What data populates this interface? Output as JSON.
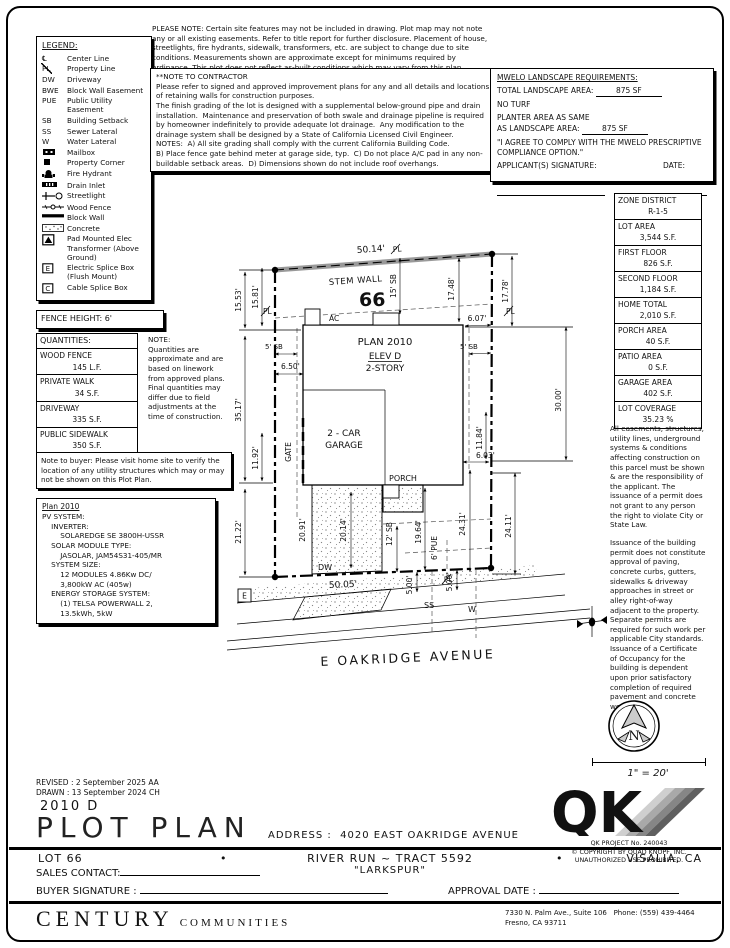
{
  "header": {
    "please_note": "PLEASE NOTE:  Certain site features may not be included in drawing.  Plot map may not note any or all existing easements.  Refer to title report for further disclosure.  Placement of house, streetlights, fire hydrants, sidewalk, transformers, etc. are subject to change due to site conditions.  Measurements shown are approximate except for minimums required by ordinance.  This plot does not reflect as-built conditions which may vary from this plan.",
    "contractor_title": "**NOTE TO CONTRACTOR",
    "contractor_body": "Please refer to signed and approved improvement plans for any and all details and locations of retaining walls for construction purposes.\nThe finish grading of the lot is designed with a supplemental below-ground pipe and drain installation.  Maintenance and preservation of both swale and drainage pipeline is required by homeowner indefinitely to provide adequate lot drainage.  Any modification to the drainage system shall be designed by a State of California Licensed Civil Engineer.\nNOTES:  A) All site grading shall comply with the current California Building Code.\nB) Place fence gate behind meter at garage side, typ.  C) Do not place A/C pad in any non-buildable setback areas.  D) Dimensions shown do not include roof overhangs."
  },
  "mwelo": {
    "title": "MWELO LANDSCAPE REQUIREMENTS:",
    "total_label": "TOTAL LANDSCAPE AREA:",
    "total_value": "875 SF",
    "no_turf": "NO TURF",
    "planter_line1": "PLANTER AREA AS SAME",
    "planter_line2": "AS LANDSCAPE AREA:",
    "planter_value": "875 SF",
    "agreement": "\"I AGREE TO COMPLY WITH THE MWELO PRESCRIPTIVE COMPLIANCE OPTION.\"",
    "signature_label": "APPLICANT(S) SIGNATURE:",
    "date_label": "DATE:"
  },
  "legend": {
    "title": "LEGEND:",
    "ebox_letter": "E",
    "cbox_letter": "C",
    "items": [
      {
        "sym": "℄",
        "label": "Center Line"
      },
      {
        "sym": "PL",
        "label": "Property Line"
      },
      {
        "sym": "DW",
        "label": "Driveway"
      },
      {
        "sym": "BWE",
        "label": "Block Wall Easement"
      },
      {
        "sym": "PUE",
        "label": "Public Utility Easement"
      },
      {
        "sym": "SB",
        "label": "Building Setback"
      },
      {
        "sym": "SS",
        "label": "Sewer Lateral"
      },
      {
        "sym": "W",
        "label": "Water Lateral"
      },
      {
        "label": "Mailbox"
      },
      {
        "label": "Property Corner"
      },
      {
        "label": "Fire Hydrant"
      },
      {
        "label": "Drain Inlet"
      },
      {
        "label": "Streetlight"
      },
      {
        "label": "Wood Fence"
      },
      {
        "label": "Block Wall"
      },
      {
        "label": "Concrete"
      },
      {
        "label": "Pad Mounted Elec Transformer (Above Ground)"
      },
      {
        "label": "Electric Splice Box (Flush Mount)"
      },
      {
        "label": "Cable Splice Box"
      }
    ]
  },
  "fence_height": "FENCE HEIGHT: 6'",
  "quantities": {
    "title": "QUANTITIES:",
    "rows": [
      {
        "label": "WOOD FENCE",
        "value": "145 L.F."
      },
      {
        "label": "PRIVATE WALK",
        "value": "34 S.F."
      },
      {
        "label": "DRIVEWAY",
        "value": "335 S.F."
      },
      {
        "label": "PUBLIC SIDEWALK",
        "value": "350 S.F."
      }
    ],
    "note_title": "NOTE:",
    "note": "Quantities are approximate and are based on linework from approved plans.  Final quantities may differ due to field adjustments at the time of construction."
  },
  "buyer_note": "Note to buyer: Please visit home site to verify the location of any utility structures which may or may not be shown on this Plot Plan.",
  "pv": {
    "title": "Plan 2010",
    "body": "PV SYSTEM:\n    INVERTER:\n        SOLAREDGE SE 3800H-USSR\n    SOLAR MODULE TYPE:\n        JASOLAR, JAM54S31-405/MR\n    SYSTEM SIZE:\n        12 MODULES 4.86Kw DC/\n        3,800kW AC (405w)\n    ENERGY STORAGE SYSTEM:\n        (1) TELSA POWERWALL 2,\n        13.5kWh, 5kW"
  },
  "zone_table": {
    "rows": [
      {
        "label": "ZONE DISTRICT",
        "value": "R-1-5"
      },
      {
        "label": "LOT AREA",
        "value": "3,544 S.F."
      },
      {
        "label": "FIRST FLOOR",
        "value": "826 S.F."
      },
      {
        "label": "SECOND FLOOR",
        "value": "1,184 S.F."
      },
      {
        "label": "HOME TOTAL",
        "value": "2,010 S.F."
      },
      {
        "label": "PORCH AREA",
        "value": "40 S.F."
      },
      {
        "label": "PATIO AREA",
        "value": "0 S.F."
      },
      {
        "label": "GARAGE AREA",
        "value": "402 S.F."
      },
      {
        "label": "LOT COVERAGE",
        "value": "35.23 %"
      }
    ]
  },
  "right_notes": {
    "p1": "All easements, structures, utility lines, underground systems & conditions affecting construction on this parcel must be shown & are the responsibility of the applicant. The issuance of a permit does not grant to any person the right to violate City or State Law.",
    "p2": "Issuance of the building permit does not constitute approval of paving, concrete curbs, gutters, sidewalks & driveway approaches in street or alley right-of-way adjacent to the property. Separate permits are required for such work per applicable City standards. Issuance of a Certificate of Occupancy for the building is dependent upon prior satisfactory completion of required pavement and concrete work."
  },
  "plot": {
    "d50_14": "50.14'",
    "stem_wall": "STEM WALL",
    "pl": "PL",
    "lot_number": "66",
    "d15_53": "15.53'",
    "d15_81": "15.81'",
    "sb15": "15' SB",
    "d17_48": "17.48'",
    "d17_78": "17.78'",
    "d6_07": "6.07'",
    "sb5": "5' SB",
    "d6_50": "6.50'",
    "ac": "AC",
    "plan_name": "PLAN 2010",
    "elev": "ELEV D",
    "story": "2-STORY",
    "d35_17": "35.17'",
    "d11_92": "11.92'",
    "gate": "GATE",
    "d30_00": "30.00'",
    "d11_84": "11.84'",
    "garage_line1": "2 - CAR",
    "garage_line2": "GARAGE",
    "d6_03": "6.03'",
    "porch": "PORCH",
    "d21_22": "21.22'",
    "d20_91": "20.91'",
    "d20_14": "20.14'",
    "sb12": "12' SB",
    "d19_64": "19.64'",
    "d24_31": "24.31'",
    "d24_11": "24.11'",
    "pue6": "6' PUE",
    "d5_00": "5.00'",
    "dw": "DW",
    "d50_05": "50.05'",
    "ss": "SS",
    "w": "W",
    "ebox": "E",
    "street": "E OAKRIDGE AVENUE"
  },
  "compass": {
    "n": "N",
    "scale": "1\" = 20'"
  },
  "qk": {
    "letters": "QK",
    "project": "QK PROJECT No. 240043",
    "copyright": "© COPYRIGHT BY QUAD KNOPF, INC.",
    "unauthorized": "UNAUTHORIZED USE PROHIBITED."
  },
  "titleblock": {
    "revised": "REVISED :  2 September 2025  AA",
    "drawn": "DRAWN :  13 September 2024  CH",
    "plan_code": "2010 D",
    "sheet_title": "PLOT PLAN",
    "address_label": "ADDRESS :",
    "address_value": "4020 EAST OAKRIDGE AVENUE",
    "lot": "LOT 66",
    "bullet": "•",
    "tract": "RIVER RUN ~ TRACT 5592",
    "city": "VISALIA, CA",
    "marketing": "\"LARKSPUR\"",
    "sales_contact": "SALES CONTACT:",
    "buyer_signature": "BUYER SIGNATURE :",
    "approval_date": "APPROVAL DATE :",
    "brand_primary": "CENTURY",
    "brand_secondary": "COMMUNITIES",
    "office_line1": "7330 N. Palm Ave., Suite 106",
    "office_phone": "Phone:  (559) 439-4464",
    "office_line2": "Fresno, CA  93711"
  }
}
